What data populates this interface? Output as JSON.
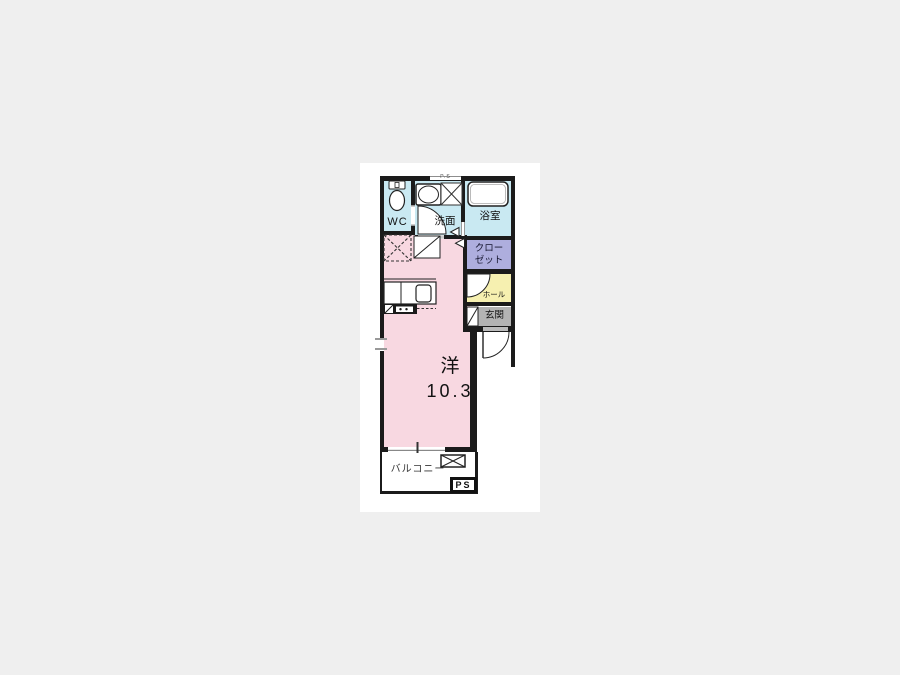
{
  "canvas": {
    "background": "#efefef",
    "panel_background": "#ffffff"
  },
  "floorplan": {
    "labels": {
      "wc": "WC",
      "washroom": "洗面",
      "bathroom": "浴室",
      "closet_line1": "クロー",
      "closet_line2": "ゼット",
      "hall": "ホール",
      "entrance": "玄関",
      "room_type": "洋",
      "room_size": "10.3",
      "balcony": "バルコニー",
      "ps_shaft": "PS",
      "ps_top": "P.S"
    },
    "colors": {
      "wall": "#1b1b1b",
      "wet_area": "#c9e9f2",
      "main_room": "#f8d8e1",
      "closet": "#aeaede",
      "hall": "#f6f0b0",
      "entrance": "#b3b3b3",
      "window_tick": "#999999"
    }
  }
}
